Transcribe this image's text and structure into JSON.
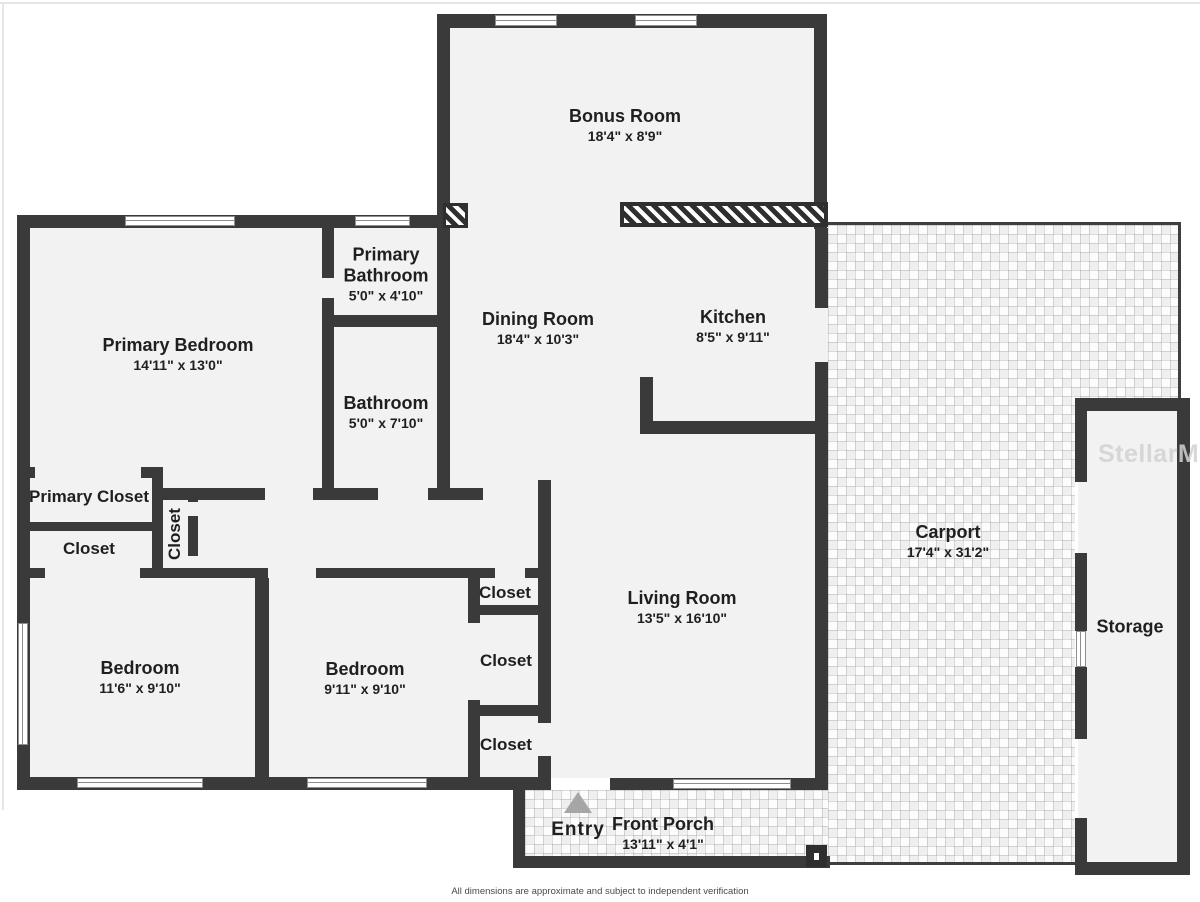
{
  "plan": {
    "rooms": {
      "bonus_room": {
        "name": "Bonus Room",
        "dims": "18'4\" x 8'9\""
      },
      "primary_bedroom": {
        "name": "Primary Bedroom",
        "dims": "14'11\" x 13'0\""
      },
      "primary_bathroom": {
        "name": "Primary Bathroom",
        "dims": "5'0\" x 4'10\""
      },
      "bathroom": {
        "name": "Bathroom",
        "dims": "5'0\" x 7'10\""
      },
      "dining_room": {
        "name": "Dining Room",
        "dims": "18'4\" x 10'3\""
      },
      "kitchen": {
        "name": "Kitchen",
        "dims": "8'5\" x 9'11\""
      },
      "living_room": {
        "name": "Living Room",
        "dims": "13'5\" x 16'10\""
      },
      "carport": {
        "name": "Carport",
        "dims": "17'4\" x 31'2\""
      },
      "storage": {
        "name": "Storage"
      },
      "bedroom_left": {
        "name": "Bedroom",
        "dims": "11'6\" x 9'10\""
      },
      "bedroom_middle": {
        "name": "Bedroom",
        "dims": "9'11\" x 9'10\""
      },
      "front_porch": {
        "name": "Front Porch",
        "dims": "13'11\" x 4'1\""
      }
    },
    "closets": {
      "primary_closet": "Primary Closet",
      "hall_closet": "Closet",
      "vertical_closet": "Closet",
      "closet_top": "Closet",
      "closet_middle": "Closet",
      "closet_bottom": "Closet"
    },
    "entry_label": "Entry",
    "watermark": "StellarMLS",
    "disclaimer": "All dimensions are approximate and subject to independent verification",
    "colors": {
      "wall": "#3a3a3a",
      "room_fill": "#f2f2f2",
      "text": "#1f1f1f",
      "entry_arrow": "#a6a6a6",
      "watermark": "#d2d2d2"
    }
  }
}
